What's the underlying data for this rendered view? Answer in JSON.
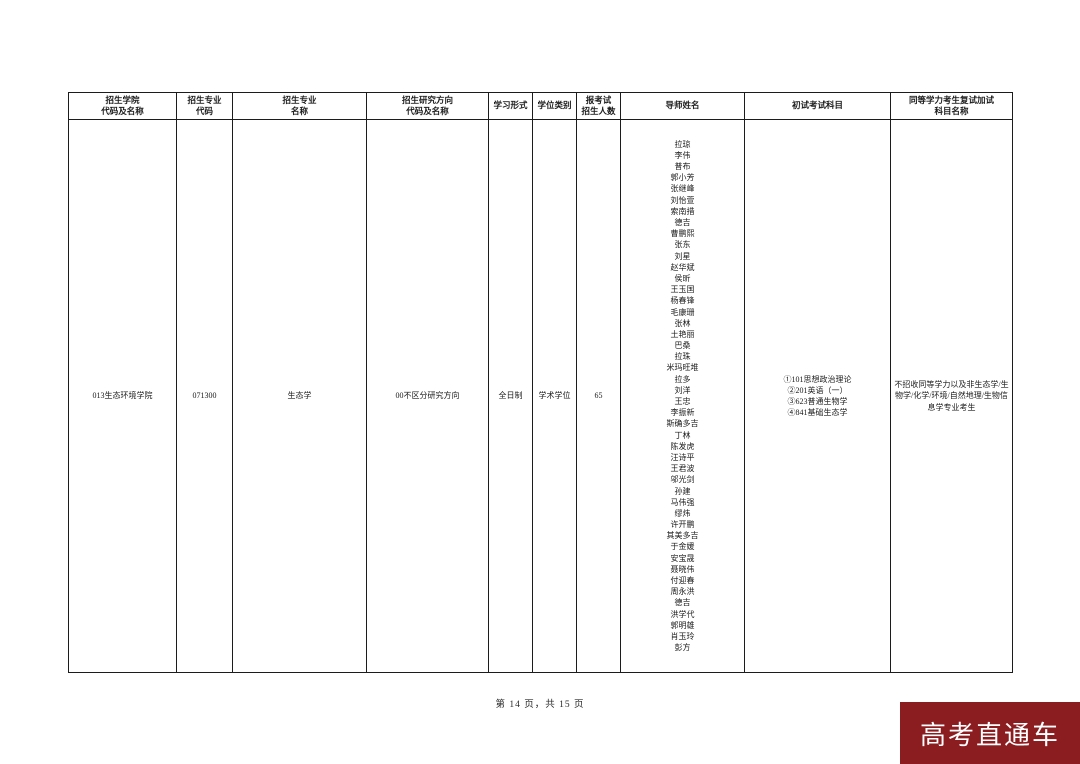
{
  "table": {
    "headers": [
      "招生学院\n代码及名称",
      "招生专业\n代码",
      "招生专业\n名称",
      "招生研究方向\n代码及名称",
      "学习形式",
      "学位类别",
      "报考试\n招生人数",
      "导师姓名",
      "初试考试科目",
      "同等学力考生复试加试\n科目名称"
    ],
    "row": {
      "college": "013生态环境学院",
      "major_code": "071300",
      "major_name": "生态学",
      "direction": "00不区分研究方向",
      "study_form": "全日制",
      "degree_type": "学术学位",
      "enrollment": "65",
      "supervisors": [
        "拉琼",
        "李伟",
        "普布",
        "郭小芳",
        "张继峰",
        "刘怡萱",
        "索南措",
        "德吉",
        "曹鹏熙",
        "张东",
        "刘星",
        "赵华斌",
        "侯昕",
        "王玉国",
        "杨春锋",
        "毛康珊",
        "张林",
        "土艳丽",
        "巴桑",
        "拉珠",
        "米玛旺堆",
        "拉多",
        "刘洋",
        "王忠",
        "李振新",
        "斯确多吉",
        "丁林",
        "陈发虎",
        "汪诗平",
        "王君波",
        "邬光剑",
        "孙建",
        "马伟强",
        "缪炜",
        "许开鹏",
        "其美多吉",
        "于金媛",
        "安宝晟",
        "聂晓伟",
        "付迎春",
        "周永洪",
        "德吉",
        "洪学代",
        "郭明雄",
        "肖玉玲",
        "彭方"
      ],
      "exam_subjects": [
        "①101思想政治理论",
        "②201英语（一）",
        "③623普通生物学",
        "④841基础生态学"
      ],
      "additional_subjects": "不招收同等学力以及非生态学/生物学/化学/环境/自然地理/生物信息学专业考生"
    }
  },
  "footer": {
    "page_info": "第 14 页，共 15 页"
  },
  "watermark": {
    "text": "高考直通车",
    "bg_color": "#8B1C20",
    "text_color": "#FFFFFF"
  }
}
